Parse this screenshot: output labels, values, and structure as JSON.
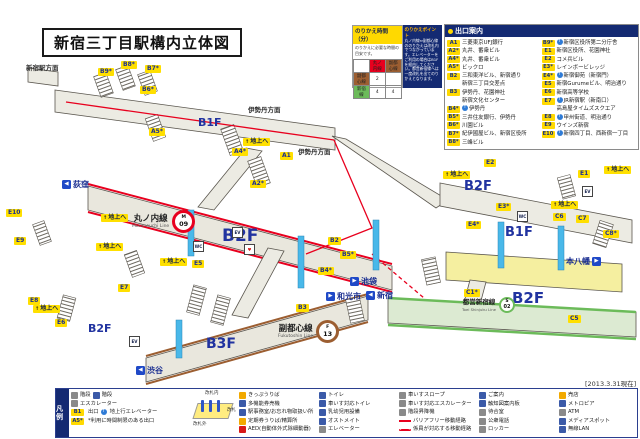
{
  "title": "新宿三丁目駅構内立体図",
  "date_note": "[2013.3.31現在]",
  "transfer": {
    "title": "のりかえ時間（分）",
    "subtitle": "のりかえに必要な時間の目安です。",
    "table": {
      "col1": "丸ノ内線",
      "col2": "副都心線",
      "row1_label": "副都心線",
      "row1_v1": "2",
      "row1_v2": "",
      "row2_label": "新宿線",
      "row2_v1": "4",
      "row2_v2": "4"
    },
    "points_title": "のりかえポイント",
    "points_text": "丸ノ内線⇔副都心線ののりかえは改札内でつながっています。エレベーターをご利用の場合はB1Fを経由してください。都営新宿線へは一度改札を出てのりかえとなります。"
  },
  "exit_guide": {
    "title": "出口案内",
    "left": [
      {
        "code": "A1",
        "desc": "三菱東京UFJ銀行"
      },
      {
        "code": "A2*",
        "desc": "丸井、番衆ビル"
      },
      {
        "code": "A4*",
        "desc": "丸井、番衆ビル"
      },
      {
        "code": "A5*",
        "desc": "ビックロ"
      },
      {
        "code": "B2",
        "desc": "三和東洋ビル、新宿通り"
      },
      {
        "code": "",
        "desc": "新宿三丁目交差点"
      },
      {
        "code": "B3",
        "desc": "伊勢丹、花園神社"
      },
      {
        "code": "",
        "desc": "新宿文化センター"
      },
      {
        "code": "B4*",
        "desc": "伊勢丹"
      },
      {
        "code": "B5*",
        "desc": "三井住友銀行、伊勢丹"
      },
      {
        "code": "B6*",
        "desc": "川園ビル"
      },
      {
        "code": "B7*",
        "desc": "紀伊國屋ビル、新宿区役所"
      },
      {
        "code": "B8*",
        "desc": "三峰ビル"
      }
    ],
    "right": [
      {
        "code": "B9*",
        "desc": "新宿区役所第二分庁舎"
      },
      {
        "code": "E1",
        "desc": "新宿区役所、花園神社"
      },
      {
        "code": "E2",
        "desc": "コメ兵ビル"
      },
      {
        "code": "E3*",
        "desc": "レインボービレッジ"
      },
      {
        "code": "E4*",
        "desc": "新宿御苑（新宿門）"
      },
      {
        "code": "E5",
        "desc": "新宿Gurumeビル、明治通り"
      },
      {
        "code": "E6",
        "desc": "新宿高等学校"
      },
      {
        "code": "E7",
        "desc": "JR新宿駅（新南口）"
      },
      {
        "code": "",
        "desc": "高島屋タイムズスクエア"
      },
      {
        "code": "E8",
        "desc": "甲州街道、明治通り"
      },
      {
        "code": "E9",
        "desc": "ウインズ新宿"
      },
      {
        "code": "E10",
        "desc": "新宿四丁目、西新宿一丁目"
      }
    ]
  },
  "map": {
    "to_surface": "地上へ",
    "direction_top_left": "新宿駅方面",
    "isetan_direction": "伊勢丹方面",
    "colors": {
      "marunouchi": "#e8001e",
      "fukutoshin": "#9c5e31",
      "toei_shinjuku": "#6cbb5a",
      "badge_bg": "#ffdf00",
      "floor_text": "#2133a0",
      "panel_navy": "#142a72"
    },
    "lines": [
      {
        "name": "丸ノ内線",
        "en": "Marunouchi Line",
        "letter": "M",
        "num": "09"
      },
      {
        "name": "副都心線",
        "en": "Fukutoshin Line",
        "letter": "F",
        "num": "13"
      },
      {
        "name": "都営新宿線",
        "en": "Toei Shinjuku Line",
        "letter": "S",
        "num": "02"
      }
    ],
    "floors": [
      {
        "label": "B1F"
      },
      {
        "label": "B2F"
      },
      {
        "label": "B2F"
      },
      {
        "label": "B3F"
      },
      {
        "label": "B2F"
      },
      {
        "label": "B1F"
      },
      {
        "label": "B2F"
      }
    ],
    "destinations": [
      {
        "label": "荻窪"
      },
      {
        "label": "池袋"
      },
      {
        "label": "和光市"
      },
      {
        "label": "渋谷"
      },
      {
        "label": "新宿"
      },
      {
        "label": "本八幡"
      }
    ],
    "badges": [
      {
        "label": "B9*"
      },
      {
        "label": "B8*"
      },
      {
        "label": "B7*"
      },
      {
        "label": "B6*"
      },
      {
        "label": "A5*"
      },
      {
        "label": "A4*"
      },
      {
        "label": "A2*"
      },
      {
        "label": "A1"
      },
      {
        "label": "B2"
      },
      {
        "label": "B3"
      },
      {
        "label": "B4*"
      },
      {
        "label": "B5*"
      },
      {
        "label": "E5"
      },
      {
        "label": "E7"
      },
      {
        "label": "E8"
      },
      {
        "label": "E9"
      },
      {
        "label": "E10"
      },
      {
        "label": "E6"
      },
      {
        "label": "E1"
      },
      {
        "label": "E2"
      },
      {
        "label": "E3*"
      },
      {
        "label": "E4*"
      },
      {
        "label": "C6"
      },
      {
        "label": "C7"
      },
      {
        "label": "C8*"
      },
      {
        "label": "C5"
      },
      {
        "label": "C1*"
      }
    ],
    "icons": [
      {
        "glyph": "WC"
      },
      {
        "glyph": "EV"
      },
      {
        "glyph": "♥"
      },
      {
        "glyph": "WC"
      },
      {
        "glyph": "EV"
      },
      {
        "glyph": "EV"
      }
    ]
  },
  "legend": {
    "title": "凡例",
    "left": {
      "stairs1": "階段",
      "stairs2": "階段",
      "escalator": "エスカレーター",
      "exit_chip": "B1",
      "exit_word": "出口",
      "elevator_note": "地上行エレベーター",
      "restricted_chip": "A5*",
      "restricted_note": "*利用に時間制限のある出口"
    },
    "gate": {
      "inside": "改札内",
      "gate": "改札",
      "outside": "改札外"
    },
    "cols": [
      {
        "items": [
          "きっぷうりば",
          "多機能券売機",
          "駅事務室/お忘れ物取扱い所",
          "定期券うりば/精算所",
          "AED(自動体外式除細動器)"
        ]
      },
      {
        "items": [
          "トイレ",
          "車いす対応トイレ",
          "乳幼児用設備",
          "オストメイト",
          "エレベーター"
        ]
      },
      {
        "items": [
          "車いすスロープ",
          "車いす対応エスカレーター",
          "階段昇降機",
          "バリアフリー移動経路",
          "係員が対応する移動経路"
        ]
      },
      {
        "items": [
          "ご案内",
          "触知図案内板",
          "待合室",
          "公衆電話",
          "ロッカー"
        ]
      },
      {
        "items": [
          "売店",
          "メトロピア",
          "ATM",
          "メディアスポット",
          "無線LAN"
        ]
      }
    ]
  }
}
